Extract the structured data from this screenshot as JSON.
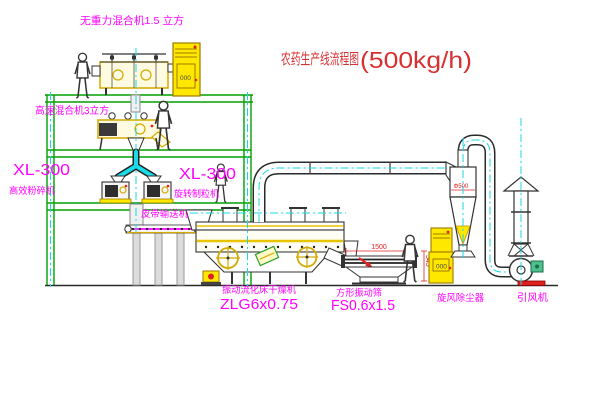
{
  "title": {
    "main": "农药生产线流程图",
    "capacity": "(500kg/h)"
  },
  "labels": {
    "gravity_free_mixer": "无重力混合机1.5 立方",
    "high_speed_mixer": "高速混合机3立方",
    "pulverizer_model": "XL-300",
    "pulverizer_name": "高效粉碎机",
    "granulator_model": "XL-300",
    "granulator_name": "旋转制粒机",
    "belt_conveyor": "皮带输送机",
    "fluid_bed_dryer_name": "振动流化床干燥机",
    "fluid_bed_dryer_model": "ZLG6x0.75",
    "vibrating_screen_name": "方形振动筛",
    "vibrating_screen_model": "FS0.6x1.5",
    "cyclone_dust_collector": "旋风除尘器",
    "induced_draft_fan": "引风机"
  },
  "dimensions": {
    "screen_length": "1500",
    "screen_height": "545",
    "cyclone_diameter": "Φ500"
  },
  "cabinets": {
    "display1": "000",
    "display2": "000"
  },
  "colors": {
    "background": "#ffffff",
    "structure_green": "#00a000",
    "equipment_yellow": "#e8c400",
    "cabinet_yellow": "#ffe800",
    "centerline_cyan": "#17d8e6",
    "label_magenta": "#ff00ff",
    "title_red": "#d83030",
    "dimension_red": "#e02020",
    "line_black": "#2a2a2a"
  }
}
